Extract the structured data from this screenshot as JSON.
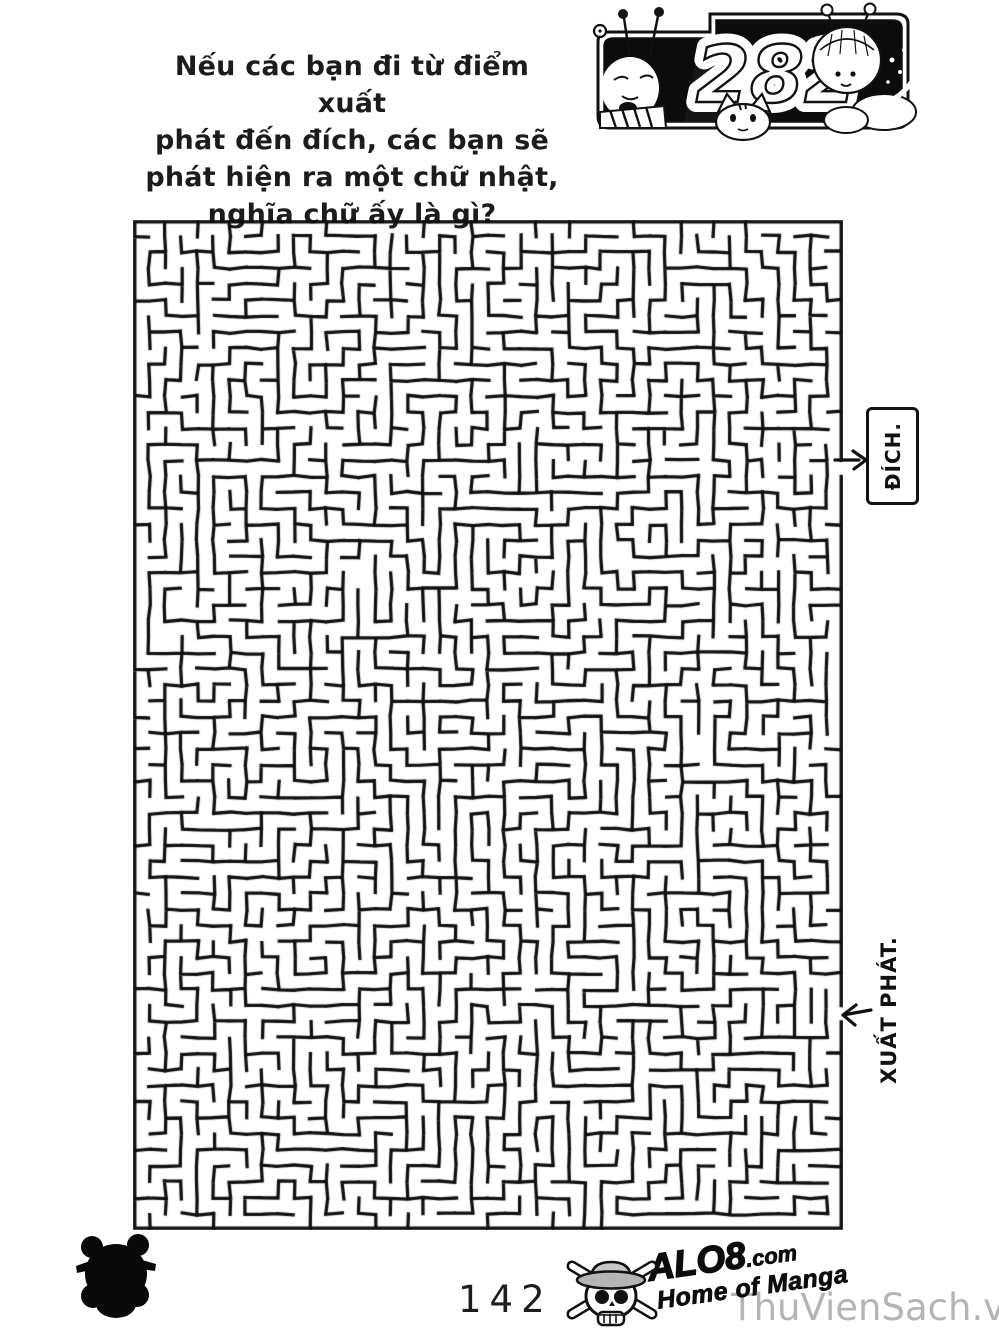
{
  "page": {
    "background": "#ffffff"
  },
  "question": {
    "lines": [
      "Nếu các bạn đi từ điểm xuất",
      "phát đến đích, các bạn sẽ",
      "phát hiện ra một chữ nhật,",
      "nghĩa chữ ấy là gì?"
    ]
  },
  "header_panel": {
    "chapter_number": "282",
    "art_icons": [
      "old-man-antennae-character",
      "snail-icon",
      "cat-icon",
      "girl-antennae-character"
    ]
  },
  "maze": {
    "goal_label": "ĐÍCH.",
    "start_label": "XUẤT PHÁT.",
    "cols": 44,
    "rows": 63,
    "seed": 20,
    "extra_openings": 70,
    "exit_row": 15,
    "entrance_row": 49,
    "wall_color": "#0f0f0f"
  },
  "footer": {
    "page_number": "142",
    "logo_name": "ALO8",
    "logo_tld": ".com",
    "logo_tagline": "Home of Manga",
    "watermark": "ThuVienSach.vn",
    "watermark_color": "#b4b4b4",
    "icons": {
      "corner": "skull-crossbones-icon",
      "logo": "strawhat-skull-icon"
    }
  }
}
